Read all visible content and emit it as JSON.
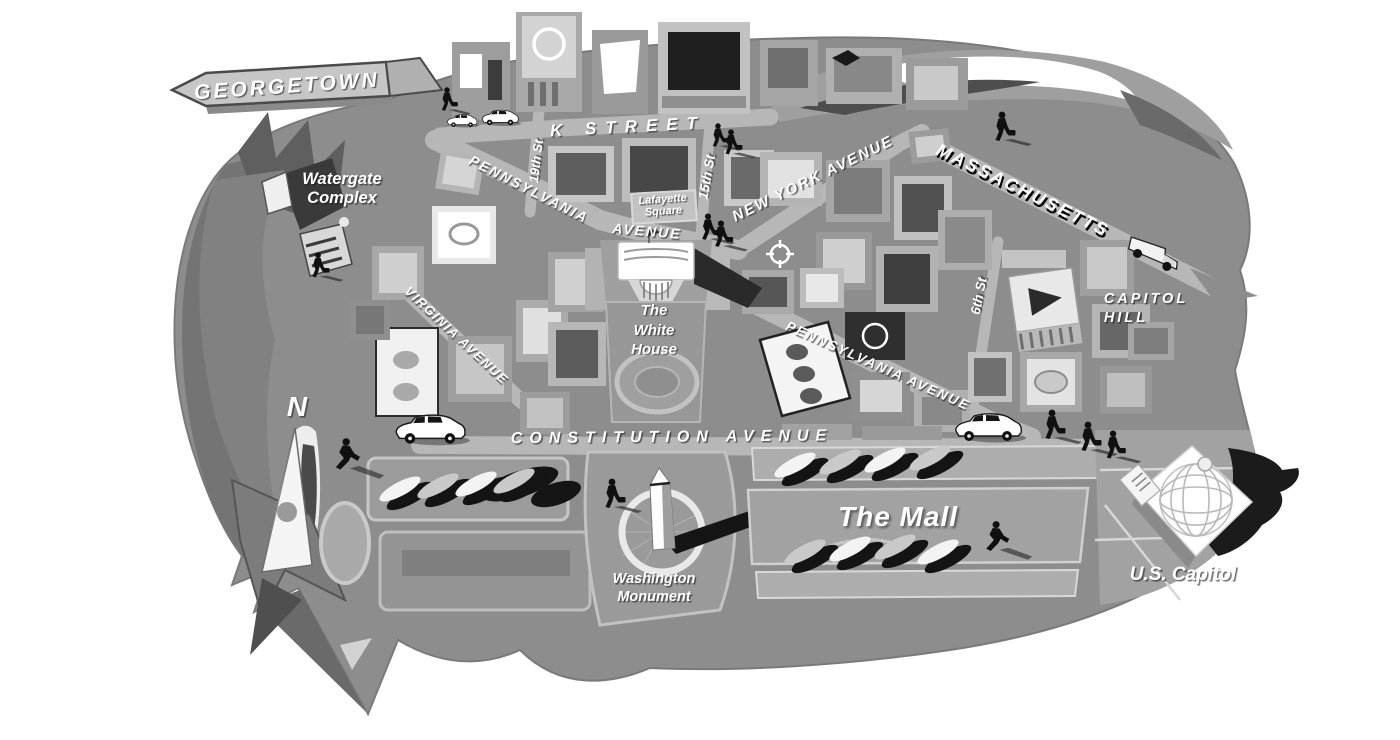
{
  "colors": {
    "background": "#ffffff",
    "map_base": "#8d8d8d",
    "street": "#b7b7b7",
    "label_text": "#ffffff",
    "figure_silhouette": "#101010",
    "sign_fill": "#c6c6c6"
  },
  "compass": {
    "north": "N"
  },
  "sign": {
    "georgetown": "GEORGETOWN"
  },
  "streets": {
    "k_street": "K STREET",
    "street_19th": "19th St",
    "street_15th": "15th St",
    "street_6th": "6th St",
    "pennsylvania_nw": {
      "line1": "PENNSYLVANIA",
      "line2": "AVENUE"
    },
    "new_york_avenue": "NEW YORK AVENUE",
    "massachusetts": "MASSACHUSETTS",
    "virginia_avenue": "VIRGINIA AVENUE",
    "pennsylvania_se": "PENNSYLVANIA AVENUE",
    "constitution_avenue": "CONSTITUTION AVENUE"
  },
  "places": {
    "watergate": {
      "line1": "Watergate",
      "line2": "Complex"
    },
    "lafayette": {
      "line1": "Lafayette",
      "line2": "Square"
    },
    "white_house": {
      "line1": "The",
      "line2": "White",
      "line3": "House"
    },
    "capitol_hill": {
      "line1": "CAPITOL",
      "line2": "HILL"
    },
    "washington_monument": {
      "line1": "Washington",
      "line2": "Monument"
    },
    "the_mall": "The Mall",
    "us_capitol": "U.S. Capitol"
  }
}
